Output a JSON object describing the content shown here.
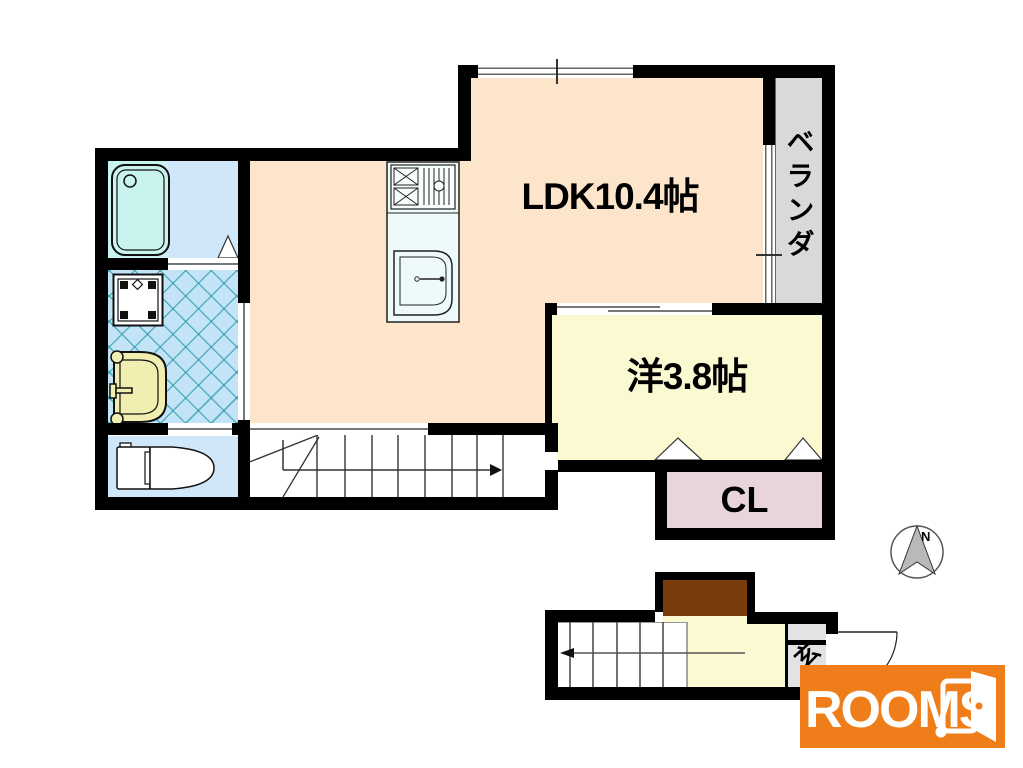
{
  "plan": {
    "type": "apartment-floorplan",
    "rooms": {
      "ldk": {
        "label": "LDK10.4帖"
      },
      "western_room": {
        "label": "洋3.8帖"
      },
      "closet": {
        "label": "CL"
      },
      "veranda": {
        "label": "ベランダ"
      },
      "entrance": {
        "label": "玄"
      }
    },
    "fixtures": [
      "bathtub",
      "washing-machine-pan",
      "vanity-sink",
      "toilet",
      "kitchen-stove",
      "kitchen-sink",
      "stairs-up",
      "stairs-down",
      "shoe-cabinet",
      "entrance-door-swing",
      "folding-closet-doors"
    ],
    "compass": {
      "north_label": "N"
    },
    "logo": {
      "brand": "ROOMS",
      "period": "."
    },
    "colors": {
      "wall": "#000000",
      "ldk": "#fce5cb",
      "western_room": "#fbf9d2",
      "closet": "#e7d5da",
      "veranda": "#d9d9d9",
      "bath": "#cfe7f9",
      "bathtub": "#c9f3ef",
      "washroom": "#c3e4f6",
      "washroom_hatch": "#1f94a8",
      "toilet_room": "#cfe7f9",
      "vanity": "#f0eeb0",
      "shoe_cabinet": "#7a3c0a",
      "entry_hall": "#fbf9d2",
      "genkan": "#e3e3e3",
      "logo_background": "#ef7d1a",
      "logo_text": "#ffffff"
    }
  }
}
